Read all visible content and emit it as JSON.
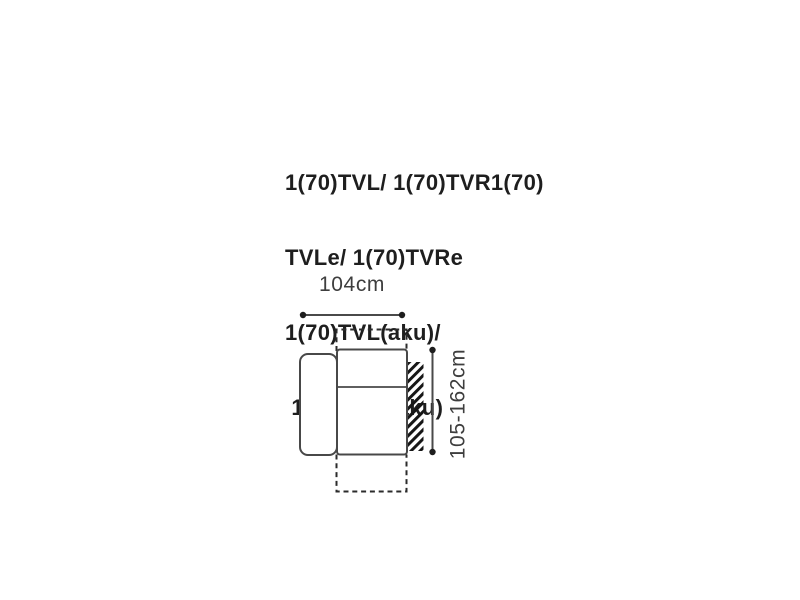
{
  "product_title": {
    "lines": [
      "1(70)TVL/ 1(70)TVR1(70)",
      "TVLe/ 1(70)TVRe",
      "1(70)TVL(aku)/",
      " 1(70)TVR(aku)"
    ]
  },
  "diagram": {
    "width_label": "104cm",
    "height_label": "105-162cm"
  },
  "colors": {
    "background": "#ffffff",
    "title_text": "#1e1e1e",
    "dimension_text": "#3e3e3e",
    "solid_outline": "#484848",
    "dashed_outline": "#2b2b2b",
    "dimension_line": "#4a4a4a",
    "hatch": "#161616"
  }
}
